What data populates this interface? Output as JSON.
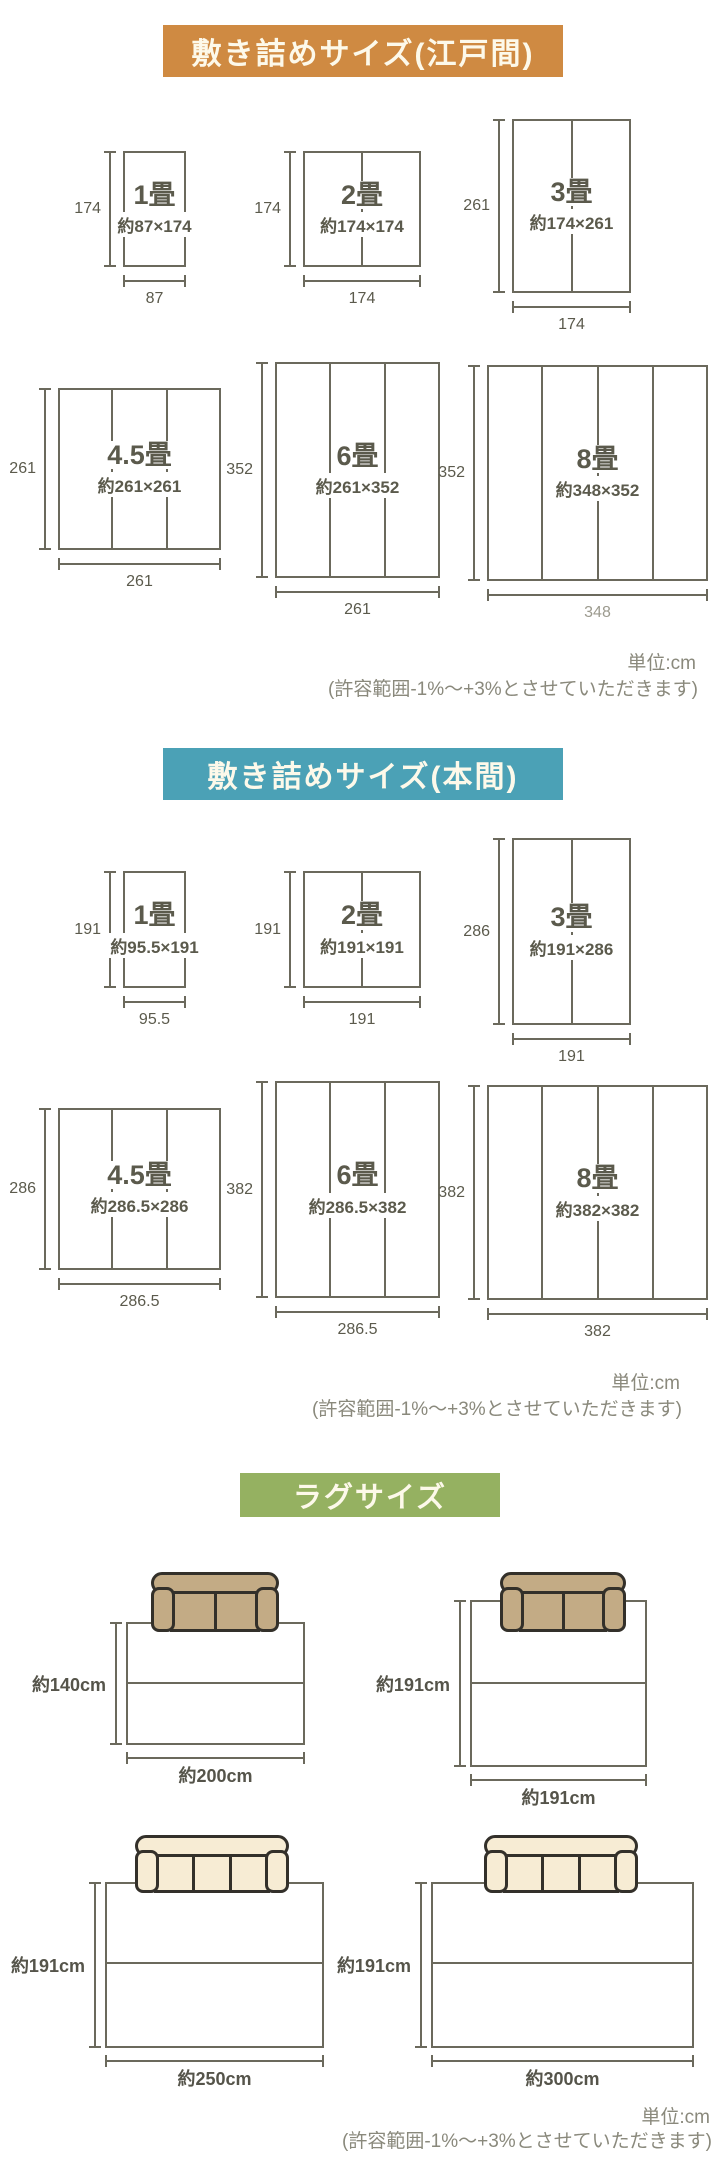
{
  "colors": {
    "edoma_header": "#cf8a42",
    "honma_header": "#4ba1b6",
    "rug_header": "#95b161",
    "header_text": "#fdf9ea",
    "line": "#6b695c",
    "footer_text": "#8a897c",
    "muted_width_label": "#9c9a8e",
    "sofa_tan": "#c3ab85",
    "sofa_cream": "#f7ecd4",
    "sofa_outline": "#33302a"
  },
  "edoma": {
    "title": "敷き詰めサイズ(江戸間)",
    "unit": "単位:cm",
    "tolerance": "(許容範囲-1%〜+3%とさせていただきます)",
    "mats": [
      {
        "name": "1畳",
        "size": "約87×174",
        "h": "174",
        "w": "87"
      },
      {
        "name": "2畳",
        "size": "約174×174",
        "h": "174",
        "w": "174"
      },
      {
        "name": "3畳",
        "size": "約174×261",
        "h": "261",
        "w": "174"
      },
      {
        "name": "4.5畳",
        "size": "約261×261",
        "h": "261",
        "w": "261"
      },
      {
        "name": "6畳",
        "size": "約261×352",
        "h": "352",
        "w": "261"
      },
      {
        "name": "8畳",
        "size": "約348×352",
        "h": "352",
        "w": "348"
      }
    ]
  },
  "honma": {
    "title": "敷き詰めサイズ(本間)",
    "unit": "単位:cm",
    "tolerance": "(許容範囲-1%〜+3%とさせていただきます)",
    "mats": [
      {
        "name": "1畳",
        "size": "約95.5×191",
        "h": "191",
        "w": "95.5"
      },
      {
        "name": "2畳",
        "size": "約191×191",
        "h": "191",
        "w": "191"
      },
      {
        "name": "3畳",
        "size": "約191×286",
        "h": "286",
        "w": "191"
      },
      {
        "name": "4.5畳",
        "size": "約286.5×286",
        "h": "286",
        "w": "286.5"
      },
      {
        "name": "6畳",
        "size": "約286.5×382",
        "h": "382",
        "w": "286.5"
      },
      {
        "name": "8畳",
        "size": "約382×382",
        "h": "382",
        "w": "382"
      }
    ]
  },
  "rug": {
    "title": "ラグサイズ",
    "unit": "単位:cm",
    "tolerance": "(許容範囲-1%〜+3%とさせていただきます)",
    "items": [
      {
        "h": "約140cm",
        "w": "約200cm"
      },
      {
        "h": "約191cm",
        "w": "約191cm"
      },
      {
        "h": "約191cm",
        "w": "約250cm"
      },
      {
        "h": "約191cm",
        "w": "約300cm"
      }
    ]
  }
}
